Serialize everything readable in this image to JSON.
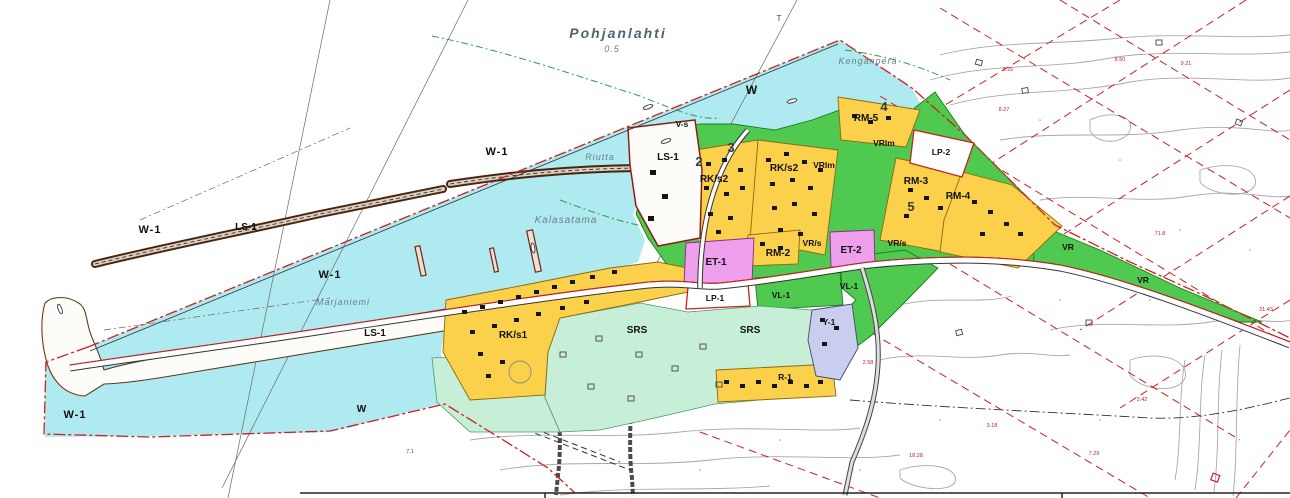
{
  "map": {
    "sea_name": "Pohjanlahti",
    "sea_depth": "0.5",
    "survey_mark": "T"
  },
  "places": {
    "kenkapera": "Kengänperä",
    "riutta": "Riutta",
    "kalasatama": "Kalasatama",
    "marjaniemi": "Marjaniemi"
  },
  "water_zones": {
    "w1": "W-1",
    "w": "W"
  },
  "zones": {
    "ls1": "LS-1",
    "vs": "V-s",
    "rks1": "RK/s1",
    "rks2": "RK/s2",
    "rm2": "RM-2",
    "rm3": "RM-3",
    "rm4": "RM-4",
    "rm5": "RM-5",
    "vrlm": "VRlm",
    "vrs": "VR/s",
    "vr": "VR",
    "vl1": "VL-1",
    "lp1": "LP-1",
    "lp2": "LP-2",
    "et1": "ET-1",
    "et2": "ET-2",
    "y1": "Y-1",
    "srs": "SRS",
    "r1": "R-1"
  },
  "block_numbers": {
    "b2": "2",
    "b3": "3",
    "b4": "4",
    "b5": "5"
  },
  "survey_numbers": {
    "n1": "7.1",
    "n2": "9.25",
    "n3": "8.27",
    "n4": "9.21",
    "n5": "8.50",
    "n6": "71.8",
    "n7": "21.43",
    "n8": "3.42",
    "n9": "3.18",
    "n10": "18.28",
    "n11": "7.29",
    "n12": "2.58"
  },
  "colors": {
    "water": "#aeeaf0",
    "zone_yellow": "#fbd14b",
    "zone_green": "#4fc94f",
    "zone_mint": "#c7efd7",
    "zone_pink": "#efa0ed",
    "zone_lavender": "#c9cdee",
    "boundary_red": "#cc2020",
    "contour_gray": "#a8a8a8"
  }
}
